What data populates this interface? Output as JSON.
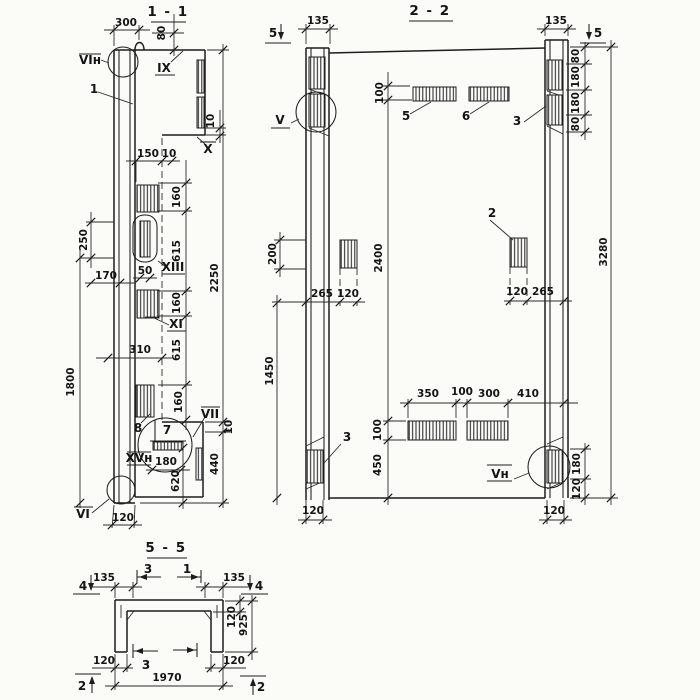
{
  "s11": {
    "title": "1 - 1",
    "labels": {
      "vin": "VIн",
      "pos1": "1",
      "ix": "IX",
      "x": "X",
      "xiii": "XIII",
      "xi": "XI",
      "vii": "VII",
      "pos7": "7",
      "pos8": "8",
      "xvn": "XVн",
      "vi": "VI"
    },
    "dims": {
      "d300": "300",
      "d80": "80",
      "d10a": "10",
      "d150": "150",
      "d10b": "10",
      "d160a": "160",
      "d615a": "615",
      "d160b": "160",
      "d615b": "615",
      "d160c": "160",
      "d2250": "2250",
      "d250": "250",
      "d170": "170",
      "d50": "50",
      "d310": "310",
      "d1800": "1800",
      "d10c": "10",
      "d440": "440",
      "d180": "180",
      "d620": "620",
      "d120": "120"
    }
  },
  "s22": {
    "title": "2 - 2",
    "marks": {
      "m5l": "5",
      "m5r": "5"
    },
    "labels": {
      "v": "V",
      "p5": "5",
      "p6": "6",
      "p3top": "3",
      "p2": "2",
      "p3bot": "3",
      "vn": "Vн"
    },
    "dims": {
      "d135l": "135",
      "d135r": "135",
      "d100top": "100",
      "d80a": "80",
      "d180a": "180",
      "d180b": "180",
      "d80b": "80",
      "d3280": "3280",
      "d200": "200",
      "d1450": "1450",
      "d2400": "2400",
      "d265l": "265",
      "d120l": "120",
      "d120r": "120",
      "d265r": "265",
      "d350": "350",
      "d100mid": "100",
      "d300": "300",
      "d410": "410",
      "d100bot": "100",
      "d450": "450",
      "d180br": "180",
      "d120br": "120",
      "d120colL": "120",
      "d120colR": "120"
    }
  },
  "s55": {
    "title": "5 - 5",
    "marks": {
      "m4l": "4",
      "m4r": "4",
      "m3top": "3",
      "m1top": "1",
      "m3bot": "3",
      "m2l": "2",
      "m2r": "2"
    },
    "dims": {
      "d135l": "135",
      "d135r": "135",
      "d120top": "120",
      "d925": "925",
      "d120bl": "120",
      "d120br": "120",
      "d1970": "1970"
    }
  }
}
